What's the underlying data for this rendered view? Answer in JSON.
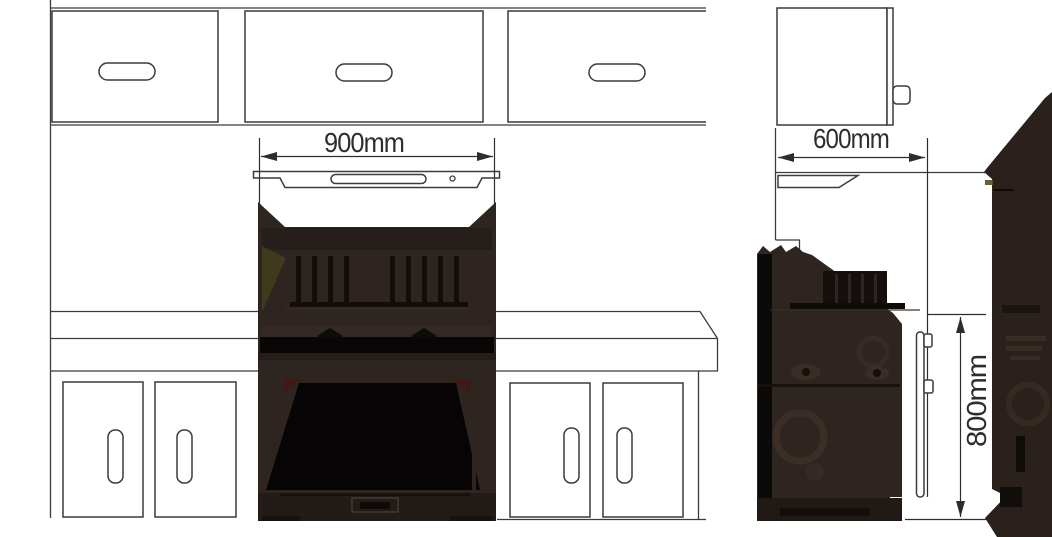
{
  "diagram": {
    "type": "appliance-installation-dimension-drawing",
    "subject": "range-cooker-between-kitchen-cabinets",
    "views": {
      "front": {
        "name": "front-elevation",
        "width_dimension": {
          "label": "900mm",
          "value_mm": 900,
          "orientation": "horizontal"
        }
      },
      "side": {
        "name": "side-elevation",
        "depth_dimension": {
          "label": "600mm",
          "value_mm": 600,
          "orientation": "horizontal"
        },
        "height_dimension": {
          "label": "800mm",
          "value_mm": 800,
          "orientation": "vertical-rotated"
        }
      }
    },
    "icons": [
      "dimension-arrow-left-icon",
      "dimension-arrow-right-icon",
      "dimension-arrow-up-icon",
      "dimension-arrow-down-icon"
    ],
    "colors": {
      "background": "#ffffff",
      "line_art": "#3d3a39",
      "dimension": "#2f2d2c",
      "silhouette_body": "#2e2420",
      "silhouette_dark": "#080606",
      "silhouette_plinth": "#231b17",
      "highlight_olive": "#4f4a1e",
      "highlight_red": "#451810"
    }
  }
}
